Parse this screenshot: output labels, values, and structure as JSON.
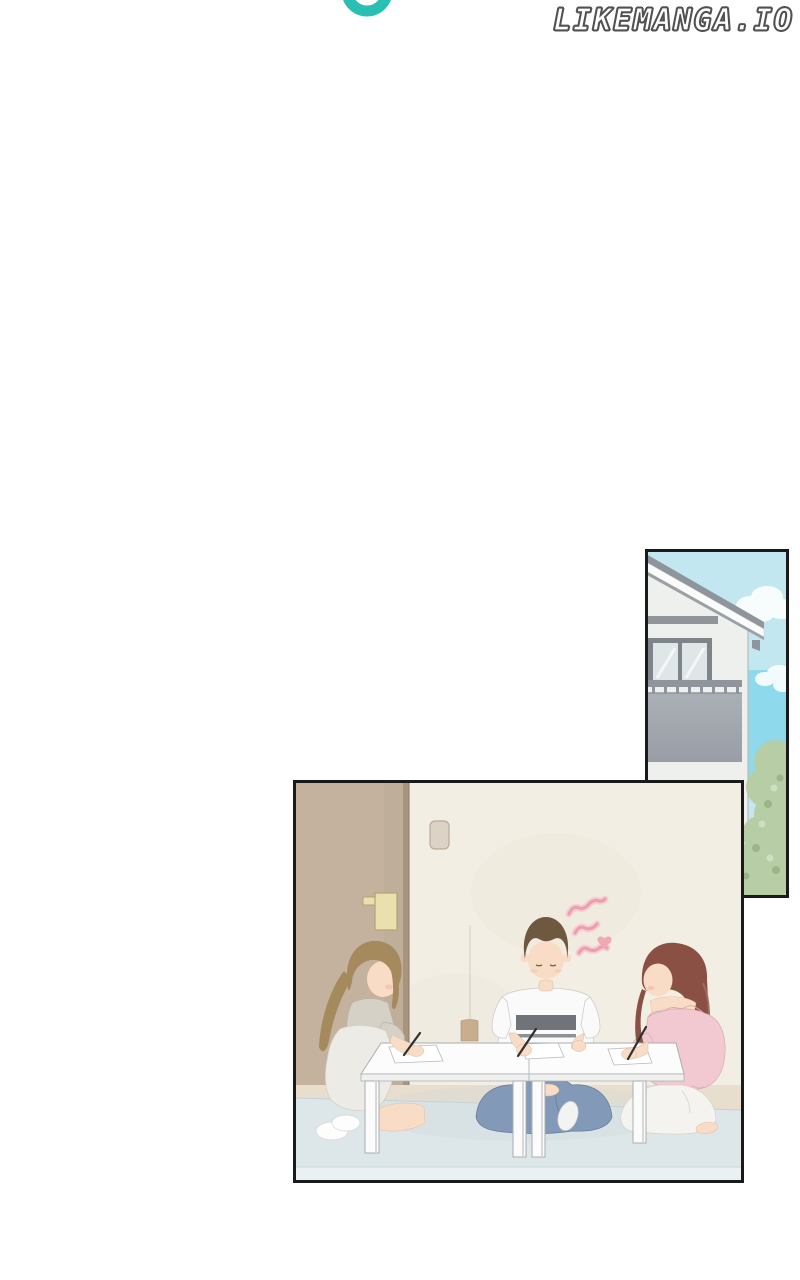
{
  "site": {
    "watermark_text": "LIKEMANGA.IO",
    "logo": {
      "name": "partial-ring-logo",
      "color": "#2abfb3"
    }
  },
  "page": {
    "background": "#ffffff",
    "panel_border_color": "#1a1a1a",
    "type": "manga-page"
  },
  "panels": {
    "house_exterior": {
      "description": "Exterior of a house gable with balcony, upper window, lower window and a green bush against a blue sky with clouds",
      "colors": {
        "sky": "#c2e7f1",
        "bright_sky": "#8ed9ec",
        "wall": "#eef0ee",
        "roof": "#8f959a",
        "balcony": "#a9adb4",
        "bush": "#b7cda6"
      }
    },
    "study_room": {
      "description": "Three people kneel at low white tables writing on papers: a woman in an apron dress at left, a flustered man in a striped tee in the middle, a woman in a pink off-shoulder top at right",
      "colors": {
        "door": "#c4b29e",
        "wall": "#f3eee4",
        "floor": "#e8decd",
        "rug": "#dde7ea",
        "table": "#fcfcfd",
        "jeans": "#8299b7",
        "pink_top": "#f2c9d1",
        "squiggle_pink": "#ee9fae",
        "skin": "#f8dcc5"
      }
    }
  }
}
